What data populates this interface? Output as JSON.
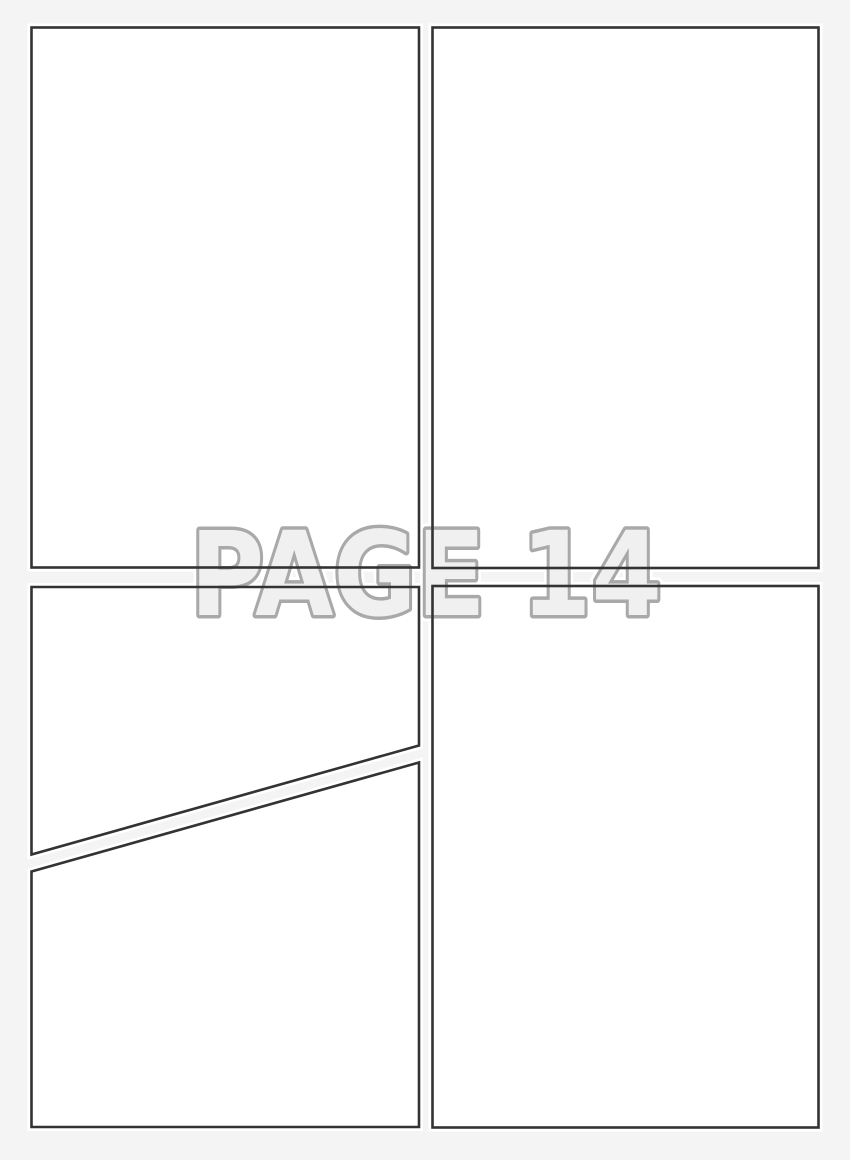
{
  "page": {
    "background_color": "#f4f4f5",
    "panel_fill_color": "#ffffff",
    "panel_halo_color": "#ffffff",
    "panel_border_color": "#333333"
  },
  "watermark": {
    "text": "PAGE 14",
    "fill_color": "#f0f0f0",
    "outline_color": "#a9a9a9",
    "halo_color": "#ffffff"
  },
  "panels": [
    {
      "id": "top-left"
    },
    {
      "id": "top-right"
    },
    {
      "id": "bottom-left-upper"
    },
    {
      "id": "bottom-left-lower"
    },
    {
      "id": "bottom-right"
    }
  ]
}
